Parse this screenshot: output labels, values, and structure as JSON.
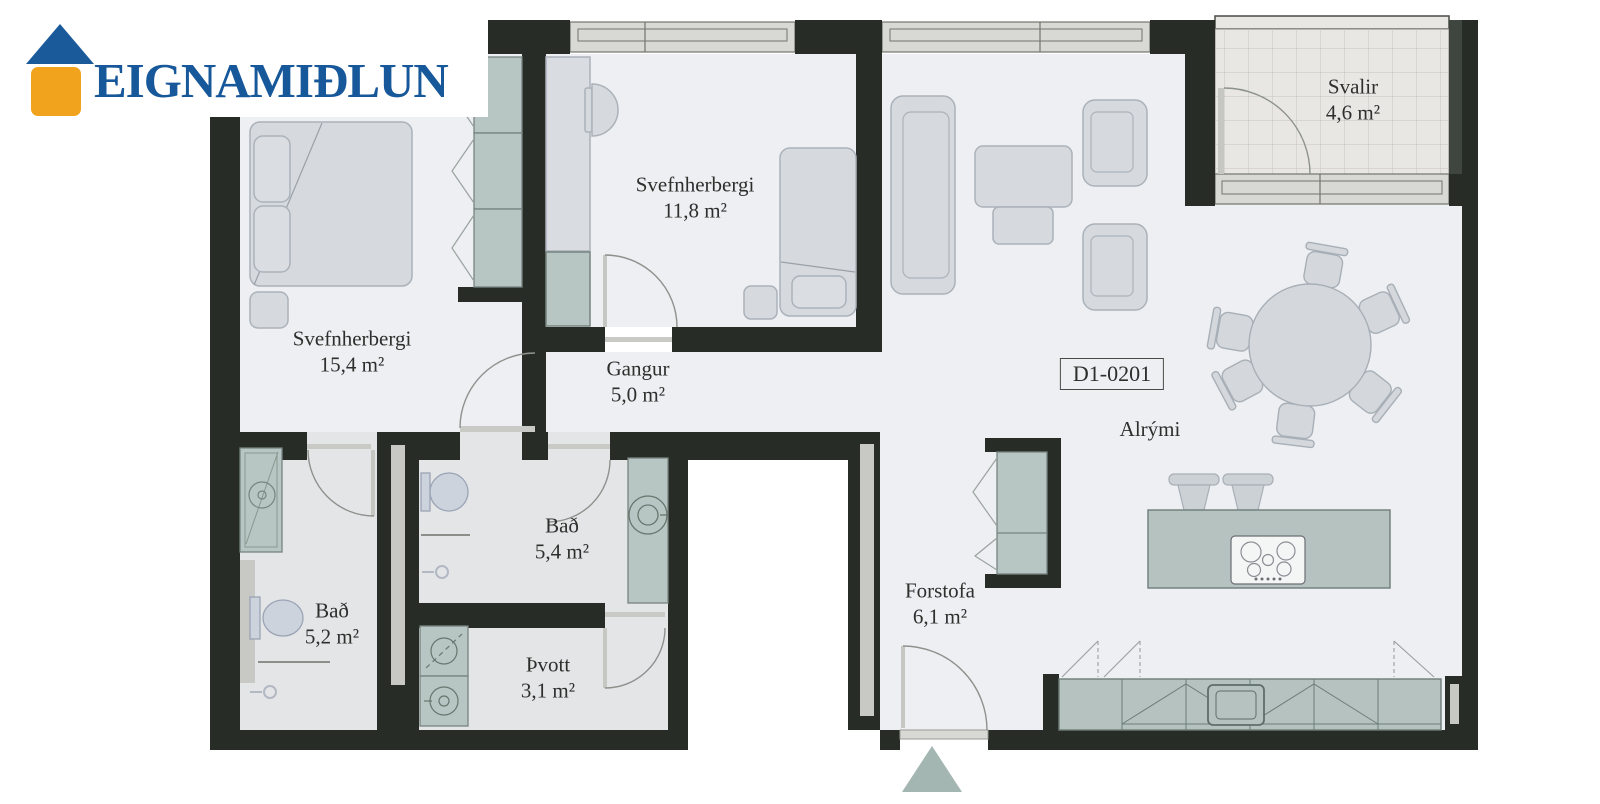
{
  "logo": {
    "brand": "EIGNAMIÐLUN"
  },
  "unit": {
    "id_label": "D1-0201"
  },
  "rooms": [
    {
      "name": "Svefnherbergi",
      "area": "15,4 m²"
    },
    {
      "name": "Svefnherbergi",
      "area": "11,8 m²"
    },
    {
      "name": "Gangur",
      "area": "5,0 m²"
    },
    {
      "name": "Bað",
      "area": "5,4 m²"
    },
    {
      "name": "Bað",
      "area": "5,2 m²"
    },
    {
      "name": "Þvott",
      "area": "3,1 m²"
    },
    {
      "name": "Forstofa",
      "area": "6,1 m²"
    },
    {
      "name": "Alrými",
      "area": ""
    },
    {
      "name": "Svalir",
      "area": "4,6 m²"
    }
  ],
  "colors": {
    "wall": "#272c27",
    "floor": "#edeff2",
    "bath_floor": "#e4e5e7",
    "fixture_green": "#b7c5c3",
    "furniture_gray": "#d6dade",
    "logo_blue": "#17589a",
    "logo_orange": "#f2a31d",
    "entry_marker": "#a4b6b2"
  }
}
